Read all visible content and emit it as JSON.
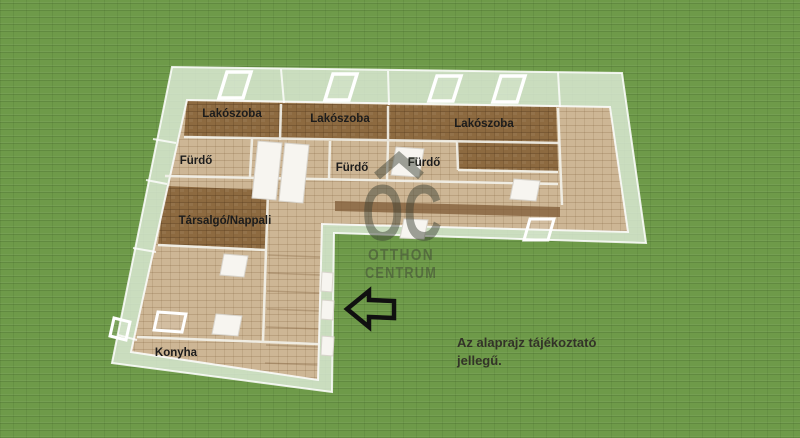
{
  "colors": {
    "grass": "#6e9a49",
    "grass_line": "#4c7a2f",
    "floor_dark": "#8d6a40",
    "floor_light": "#cdb695",
    "wall_glass": "rgba(225,237,220,0.8)",
    "wall_line": "#ffffff",
    "watermark": "#3b4034",
    "label_text": "#1c1c1c",
    "disclaimer_text": "#333328",
    "arrow_outline": "#101010"
  },
  "rooms": [
    {
      "id": "lakoszoba-1",
      "label": "Lakószoba"
    },
    {
      "id": "lakoszoba-2",
      "label": "Lakószoba"
    },
    {
      "id": "lakoszoba-3",
      "label": "Lakószoba"
    },
    {
      "id": "furdo-1",
      "label": "Fürdő"
    },
    {
      "id": "furdo-2",
      "label": "Fürdő"
    },
    {
      "id": "furdo-3",
      "label": "Fürdő"
    },
    {
      "id": "tarsalgo-nappali",
      "label": "Társalgó/Nappali"
    },
    {
      "id": "konyha",
      "label": "Konyha"
    }
  ],
  "watermark": {
    "initials": "OC",
    "line1": "OTTHON",
    "line2": "CENTRUM"
  },
  "disclaimer": {
    "line1": "Az alaprajz tájékoztató",
    "line2": "jellegű."
  },
  "icons": {
    "entrance_arrow": "left-arrow",
    "roof": "house-roof"
  }
}
